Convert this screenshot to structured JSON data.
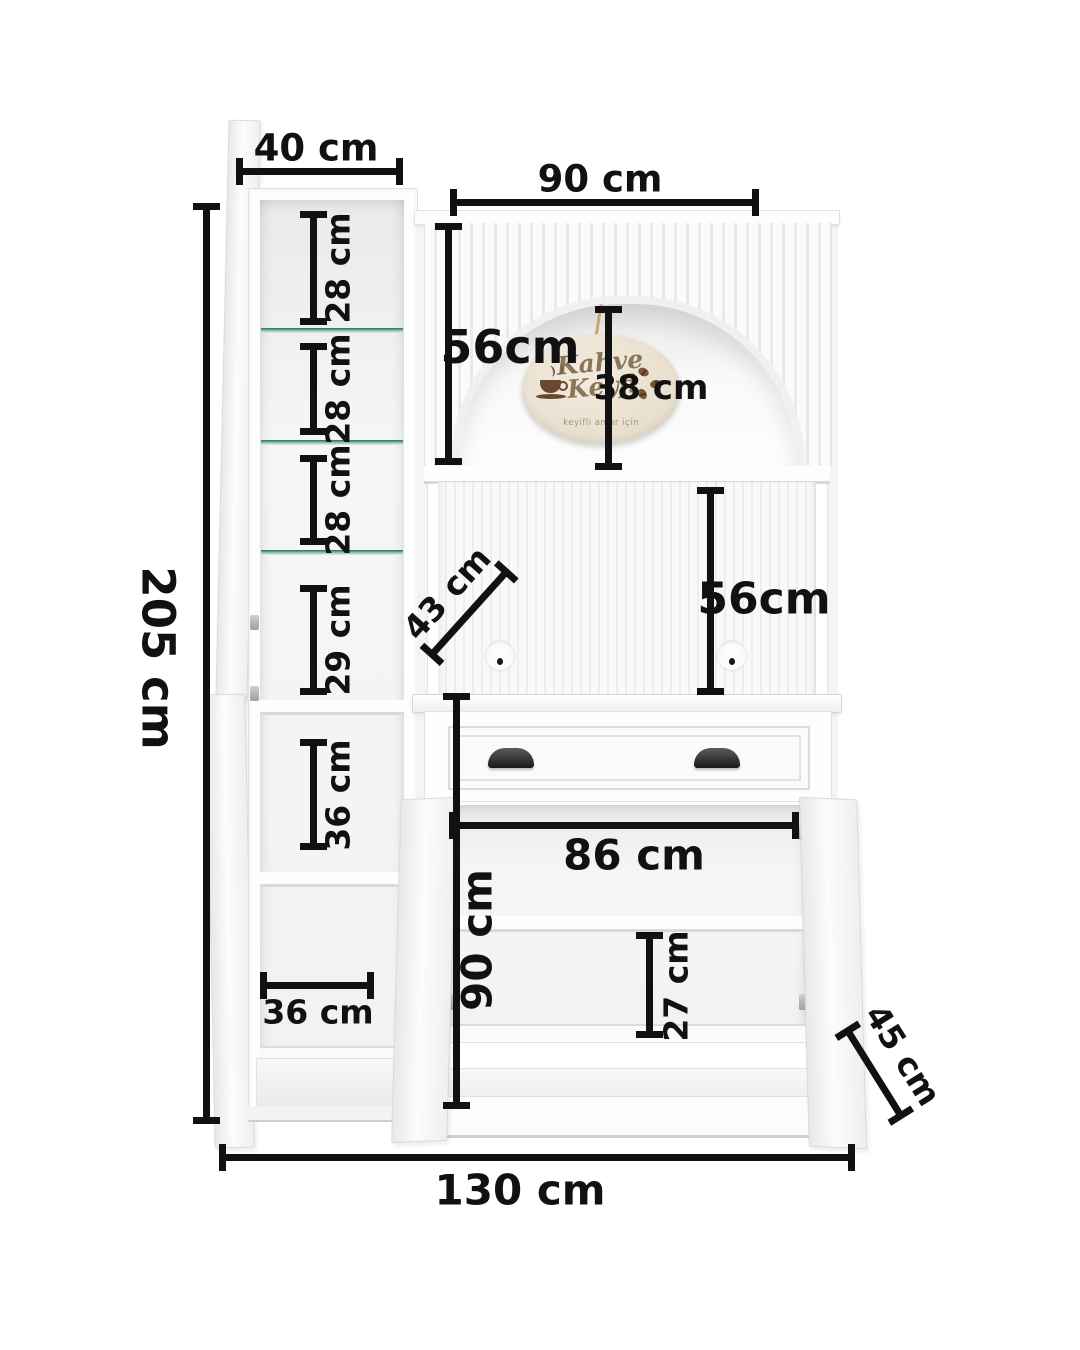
{
  "dims": {
    "door_width_top": "40 cm",
    "hutch_width": "90 cm",
    "total_height": "205 cm",
    "glass_gaps": [
      "28 cm",
      "28 cm",
      "28 cm"
    ],
    "gap_29": "29 cm",
    "gap_36_vertical": "36 cm",
    "bottom_inner_width": "36 cm",
    "arch_height": "56cm",
    "arch_inner_height": "38 cm",
    "top_depth": "43 cm",
    "mid_height": "56cm",
    "inner_width": "86 cm",
    "base_height": "90 cm",
    "base_shelf_gap": "27 cm",
    "base_depth": "45 cm",
    "total_width": "130 cm"
  },
  "sign": {
    "title": "Kahve Keyfi",
    "subtitle": "keyifli anlar için"
  },
  "colors": {
    "dimension_ink": "#111111",
    "background": "#ffffff",
    "furniture_white": "#fdfdfd",
    "glass_shelf_green": "#2e6b4e",
    "sign_background": "#e9e0cf",
    "sign_text": "#8a7556",
    "handle_black": "#181818"
  }
}
